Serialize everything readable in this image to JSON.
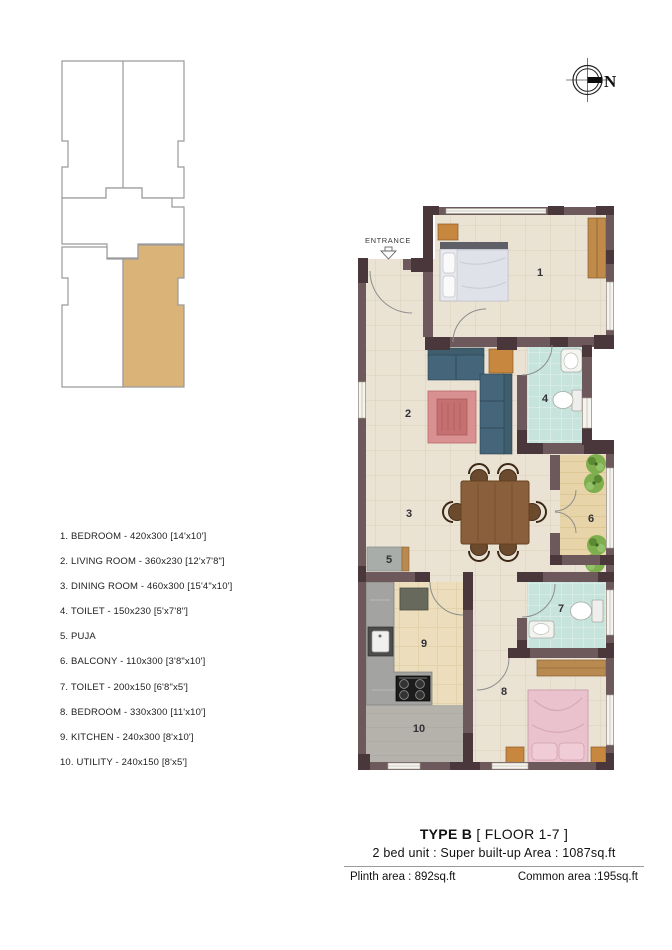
{
  "key_plan": {
    "description": "building key plan with highlighted unit"
  },
  "north": {
    "label": "N"
  },
  "entrance": {
    "label": "ENTRANCE"
  },
  "rooms": [
    "1",
    "2",
    "3",
    "4",
    "5",
    "6",
    "7",
    "8",
    "9",
    "10"
  ],
  "legend": {
    "items": [
      "1. BEDROOM - 420x300 [14'x10']",
      "2. LIVING ROOM - 360x230 [12'x7'8\"]",
      "3. DINING ROOM - 460x300 [15'4\"x10']",
      "4. TOILET - 150x230 [5'x7'8\"]",
      "5. PUJA",
      "6. BALCONY - 110x300 [3'8\"x10']",
      "7. TOILET - 200x150 [6'8\"x5']",
      "8. BEDROOM - 330x300 [11'x10']",
      "9. KITCHEN - 240x300 [8'x10']",
      "10. UTILITY - 240x150 [8'x5']"
    ]
  },
  "footer": {
    "type_label": "TYPE B",
    "floor_label": " [ FLOOR 1-7 ]",
    "unit_line": "2 bed unit : Super built-up Area : 1087sq.ft",
    "plinth": "Plinth area : 892sq.ft",
    "common": "Common area :195sq.ft"
  },
  "colors": {
    "wall": "#6d595b",
    "wall_dark": "#4a373b",
    "floor": "#eae3d4",
    "toilet_floor": "#c6e3dc",
    "balcony_floor": "#e7d5a9",
    "kitchen_floor": "#ecdebc",
    "utility_floor": "#b5b2ab",
    "highlight": "#d9b378",
    "sofa": "#3e5d6d",
    "rug": "#d99090",
    "wood": "#c8873f",
    "table_wood": "#8a5f3c",
    "bed1": "#e8e9ee",
    "bed8": "#e9c2cd",
    "plant": "#7fae4e"
  }
}
